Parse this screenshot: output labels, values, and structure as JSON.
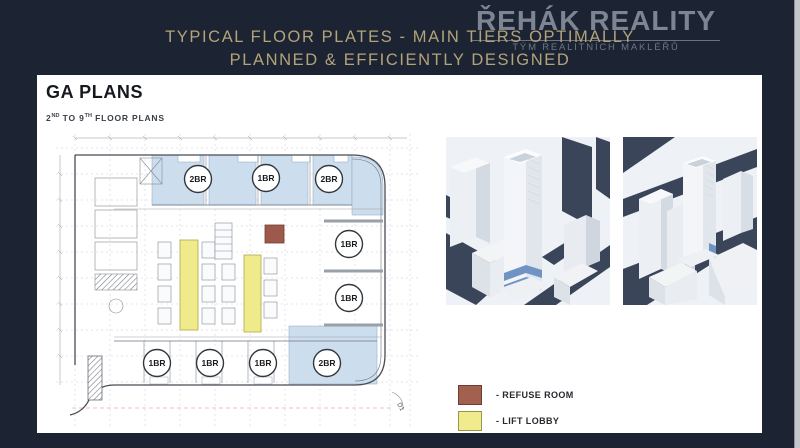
{
  "header": {
    "title_line1": "TYPICAL FLOOR PLATES - MAIN TIERS OPTIMALLY",
    "title_line2": "PLANNED & EFFICIENTLY DESIGNED"
  },
  "logo": {
    "name": "ŘEHÁK REALITY",
    "tagline": "TÝM REALITNÍCH MAKLÉŘŮ"
  },
  "panel": {
    "heading": "GA PLANS",
    "floor_range": {
      "from": "2",
      "from_suffix": "ND",
      "middle": " TO ",
      "to": "9",
      "to_suffix": "TH",
      "rest": " FLOOR PLANS"
    }
  },
  "plan": {
    "units": [
      "2BR",
      "1BR",
      "2BR",
      "1BR",
      "1BR",
      "1BR",
      "1BR",
      "1BR",
      "2BR"
    ],
    "corner_label": "D1"
  },
  "legend": {
    "items": [
      {
        "label": "- REFUSE ROOM",
        "color": "#a2604f"
      },
      {
        "label": "- LIFT LOBBY",
        "color": "#f0ec8e"
      }
    ]
  },
  "colors": {
    "background_navy": "#1c2433",
    "title_gold": "#b3a379",
    "unit_blue": "#ccdeee",
    "lift_lobby_yellow": "#efeb8a",
    "refuse_room_brown": "#9d5a4c",
    "render_dark_navy": "#3a455a",
    "render_accent_blue": "#6f94c4"
  }
}
